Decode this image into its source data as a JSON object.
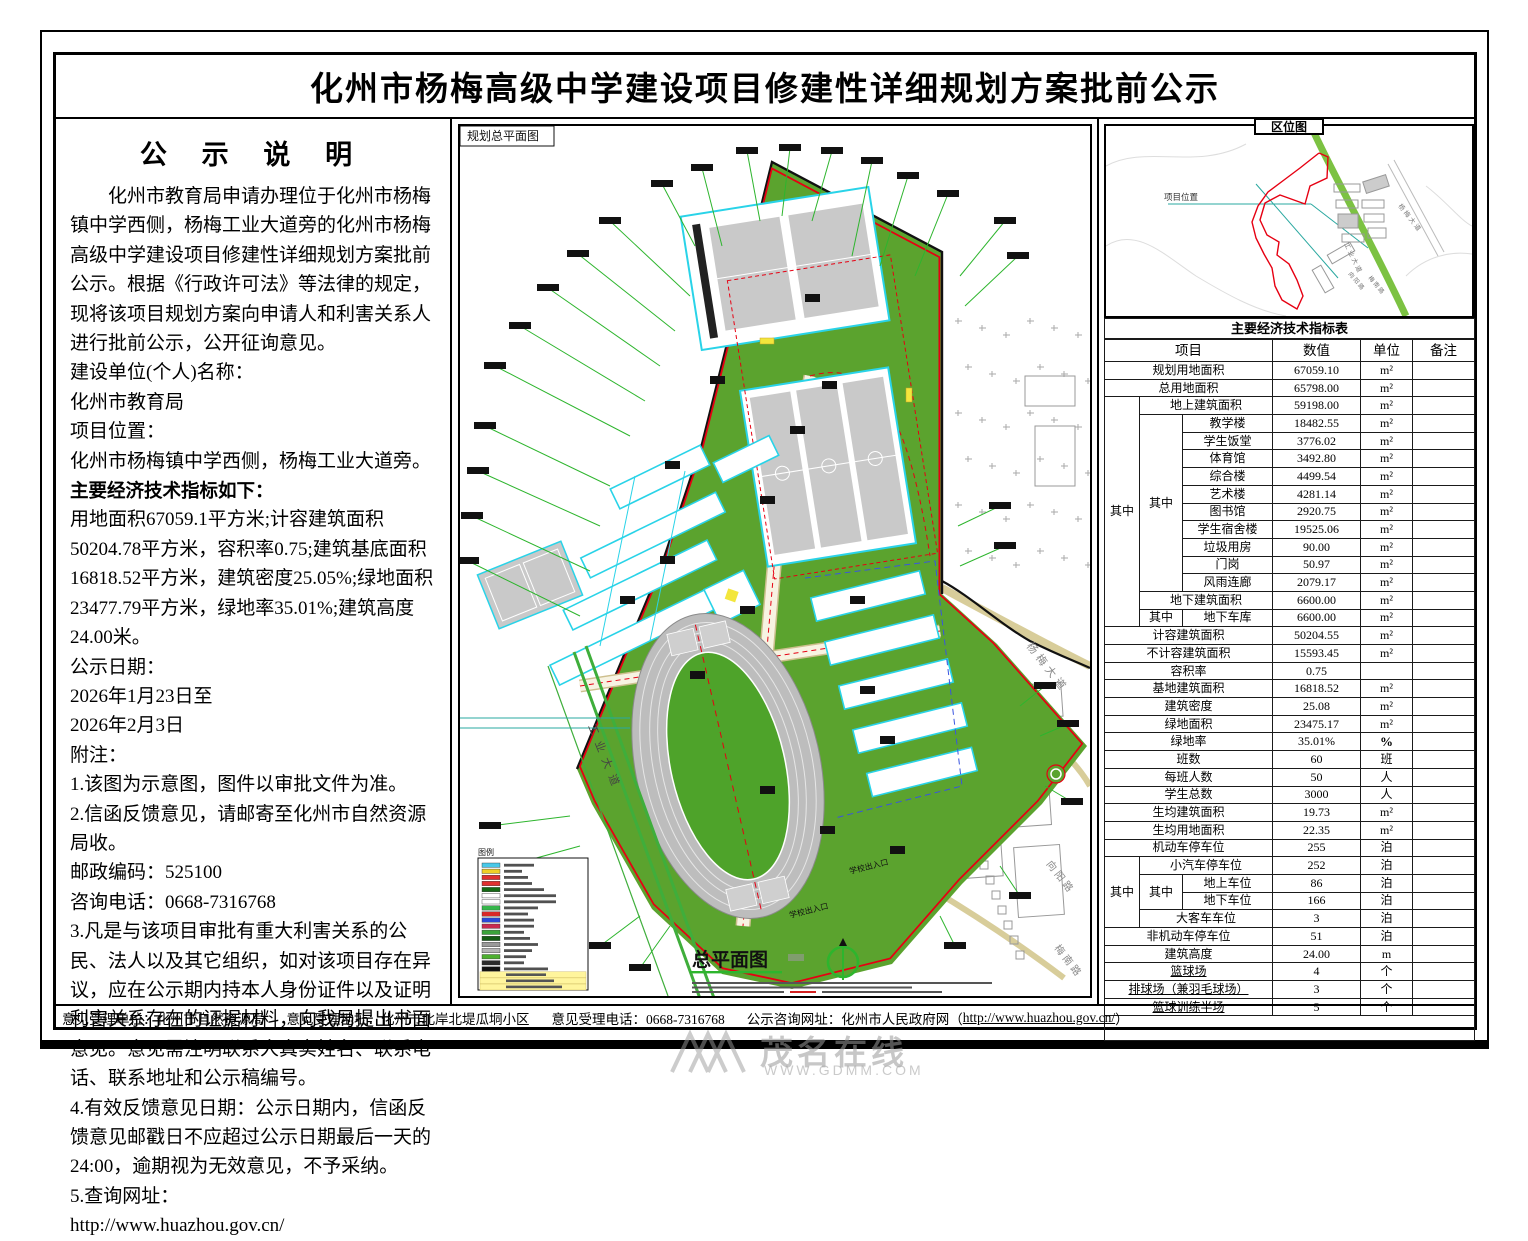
{
  "title": "化州市杨梅高级中学建设项目修建性详细规划方案批前公示",
  "notice": {
    "heading": "公 示 说 明",
    "para1": "化州市教育局申请办理位于化州市杨梅镇中学西侧，杨梅工业大道旁的化州市杨梅高级中学建设项目修建性详细规划方案批前公示。根据《行政许可法》等法律的规定，现将该项目规划方案向申请人和利害关系人进行批前公示，公开征询意见。",
    "items": [
      {
        "text": "建设单位(个人)名称："
      },
      {
        "text": "化州市教育局"
      },
      {
        "text": "项目位置："
      },
      {
        "text": "化州市杨梅镇中学西侧，杨梅工业大道旁。"
      },
      {
        "text": "主要经济技术指标如下：",
        "bold": true
      },
      {
        "text": "用地面积67059.1平方米;计容建筑面积50204.78平方米，容积率0.75;建筑基底面积16818.52平方米，建筑密度25.05%;绿地面积23477.79平方米，绿地率35.01%;建筑高度24.00米。"
      },
      {
        "text": "公示日期："
      },
      {
        "text": "2026年1月23日至"
      },
      {
        "text": "2026年2月3日"
      },
      {
        "text": "附注："
      },
      {
        "text": "1.该图为示意图，图件以审批文件为准。"
      },
      {
        "text": "2.信函反馈意见，请邮寄至化州市自然资源局收。"
      },
      {
        "text": "邮政编码：525100"
      },
      {
        "text": "咨询电话：0668-7316768"
      },
      {
        "text": "3.凡是与该项目审批有重大利害关系的公民、法人以及其它组织，如对该项目存在异议，应在公示期内持本人身份证件以及证明利害关系存在的证据材料，向我局提出书面意见。意见需注明联系人真实姓名、联系电话、联系地址和公示稿编号。"
      },
      {
        "text": "4.有效反馈意见日期：公示日期内，信函反馈意见邮戳日不应超过公示日期最后一天的24:00，逾期视为无效意见，不予采纳。"
      },
      {
        "text": "5.查询网址："
      },
      {
        "text": "http://www.huazhou.gov.cn/",
        "link": true
      }
    ]
  },
  "map": {
    "corner_label": "规划总平面图",
    "plan_title": "总平面图",
    "legend_title": "图例",
    "entrance_label": "学校出入口",
    "roads": {
      "gongye": "工业大道",
      "yangmei": "杨梅大道",
      "xiangyang": "向阳路",
      "meinan": "梅南路"
    },
    "colors": {
      "site_green": "#5ba32e",
      "building_cyan": "#29d3e8",
      "boundary_red": "#e60012",
      "road_green": "#3fae3b",
      "track_gray": "#bdbdbd"
    },
    "legend_swatches": [
      "#49c8e8",
      "#f0d028",
      "#e03030",
      "#e03030",
      "#156815",
      "#ffffff",
      "#ffffff",
      "#35b54a",
      "#d82828",
      "#2a48d8",
      "#c82a50",
      "#3aa43a",
      "#145c14",
      "#9a9a9a",
      "#b5b5b5",
      "#4db030",
      "#2a2a2a",
      "#111111"
    ],
    "legend_highlight_rows": 3
  },
  "locmap": {
    "title": "区位图",
    "project_label": "项目位置",
    "roads": {
      "gongye": "工业大道",
      "yangmei": "杨梅大道",
      "xiangyang": "向阳路",
      "meinan": "梅南路"
    }
  },
  "indicators": {
    "title": "主要经济技术指标表",
    "headers": [
      "项目",
      "数值",
      "单位",
      "备注"
    ],
    "rows": [
      {
        "label": "规划用地面积",
        "lcs": 3,
        "value": "67059.10",
        "unit": "m²"
      },
      {
        "label": "总用地面积",
        "lcs": 3,
        "value": "65798.00",
        "unit": "m²"
      },
      {
        "g1": {
          "t": "其中",
          "rs": 13
        },
        "label": "地上建筑面积",
        "lcs": 2,
        "value": "59198.00",
        "unit": "m²"
      },
      {
        "g2": {
          "t": "其中",
          "rs": 10
        },
        "label": "教学楼",
        "lcs": 1,
        "value": "18482.55",
        "unit": "m²"
      },
      {
        "label": "学生饭堂",
        "lcs": 1,
        "value": "3776.02",
        "unit": "m²"
      },
      {
        "label": "体育馆",
        "lcs": 1,
        "value": "3492.80",
        "unit": "m²"
      },
      {
        "label": "综合楼",
        "lcs": 1,
        "value": "4499.54",
        "unit": "m²"
      },
      {
        "label": "艺术楼",
        "lcs": 1,
        "value": "4281.14",
        "unit": "m²"
      },
      {
        "label": "图书馆",
        "lcs": 1,
        "value": "2920.75",
        "unit": "m²"
      },
      {
        "label": "学生宿舍楼",
        "lcs": 1,
        "value": "19525.06",
        "unit": "m²"
      },
      {
        "label": "垃圾用房",
        "lcs": 1,
        "value": "90.00",
        "unit": "m²"
      },
      {
        "label": "门岗",
        "lcs": 1,
        "value": "50.97",
        "unit": "m²"
      },
      {
        "label": "风雨连廊",
        "lcs": 1,
        "value": "2079.17",
        "unit": "m²"
      },
      {
        "label": "地下建筑面积",
        "lcs": 2,
        "value": "6600.00",
        "unit": "m²"
      },
      {
        "g2": {
          "t": "其中",
          "rs": 1
        },
        "label": "地下车库",
        "lcs": 1,
        "value": "6600.00",
        "unit": "m²"
      },
      {
        "label": "计容建筑面积",
        "lcs": 3,
        "value": "50204.55",
        "unit": "m²"
      },
      {
        "label": "不计容建筑面积",
        "lcs": 3,
        "value": "15593.45",
        "unit": "m²"
      },
      {
        "label": "容积率",
        "lcs": 3,
        "value": "0.75",
        "unit": ""
      },
      {
        "label": "基地建筑面积",
        "lcs": 3,
        "value": "16818.52",
        "unit": "m²"
      },
      {
        "label": "建筑密度",
        "lcs": 3,
        "value": "25.08",
        "unit": "m²"
      },
      {
        "label": "绿地面积",
        "lcs": 3,
        "value": "23475.17",
        "unit": "m²"
      },
      {
        "label": "绿地率",
        "lcs": 3,
        "value": "35.01%",
        "unit": "%",
        "unitBold": true
      },
      {
        "label": "班数",
        "lcs": 3,
        "value": "60",
        "unit": "班"
      },
      {
        "label": "每班人数",
        "lcs": 3,
        "value": "50",
        "unit": "人"
      },
      {
        "label": "学生总数",
        "lcs": 3,
        "value": "3000",
        "unit": "人"
      },
      {
        "label": "生均建筑面积",
        "lcs": 3,
        "value": "19.73",
        "unit": "m²"
      },
      {
        "label": "生均用地面积",
        "lcs": 3,
        "value": "22.35",
        "unit": "m²"
      },
      {
        "label": "机动车停车位",
        "lcs": 3,
        "value": "255",
        "unit": "泊"
      },
      {
        "g1": {
          "t": "其中",
          "rs": 4
        },
        "label": "小汽车停车位",
        "lcs": 2,
        "value": "252",
        "unit": "泊"
      },
      {
        "g2": {
          "t": "其中",
          "rs": 2
        },
        "label": "地上车位",
        "lcs": 1,
        "value": "86",
        "unit": "泊"
      },
      {
        "label": "地下车位",
        "lcs": 1,
        "value": "166",
        "unit": "泊"
      },
      {
        "label": "大客车车位",
        "lcs": 2,
        "value": "3",
        "unit": "泊"
      },
      {
        "label": "非机动车停车位",
        "lcs": 3,
        "value": "51",
        "unit": "泊"
      },
      {
        "label": "建筑高度",
        "lcs": 3,
        "value": "24.00",
        "unit": "m"
      },
      {
        "label": "篮球场",
        "lcs": 3,
        "value": "4",
        "unit": "个",
        "u": true
      },
      {
        "label": "排球场（兼羽毛球场）",
        "lcs": 3,
        "value": "3",
        "unit": "个",
        "u": true
      },
      {
        "label": "篮球训练半场",
        "lcs": 3,
        "value": "5",
        "unit": "个",
        "u": true
      },
      {
        "empty": true
      }
    ]
  },
  "footer": {
    "seg1": "意见受理单位：化州市自然资源局",
    "seg2": "意见受理地址：化州市北岸北堤瓜垌小区",
    "seg3": "意见受理电话：0668-7316768",
    "seg4_prefix": "公示咨询网址：化州市人民政府网（ ",
    "url": "http://www.huazhou.gov.cn/",
    "seg4_suffix": " ）"
  },
  "watermark": {
    "text": "茂名在线",
    "sub": "WWW.GDMM.COM"
  }
}
